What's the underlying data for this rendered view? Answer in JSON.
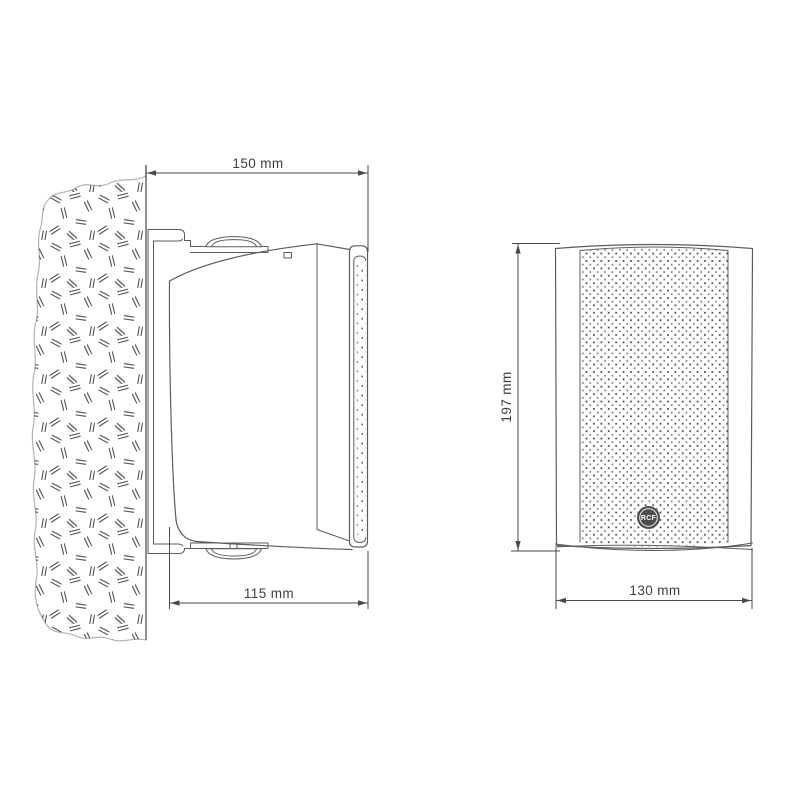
{
  "drawing": {
    "product": "wall-mount speaker technical drawing",
    "side_view": {
      "width_top_label": "150 mm",
      "depth_label": "115 mm"
    },
    "front_view": {
      "height_label": "197 mm",
      "width_label": "130 mm",
      "logo_text": "RCF"
    }
  },
  "colors": {
    "line": "#5c5c5c",
    "dim": "#4a4a4a",
    "text": "#3e3e3e",
    "wall_outline": "#b3b3b3",
    "hatch": "#4f4f4f",
    "logo_bg": "#4d4d4d",
    "logo_fg": "#ffffff",
    "background": "#ffffff"
  }
}
